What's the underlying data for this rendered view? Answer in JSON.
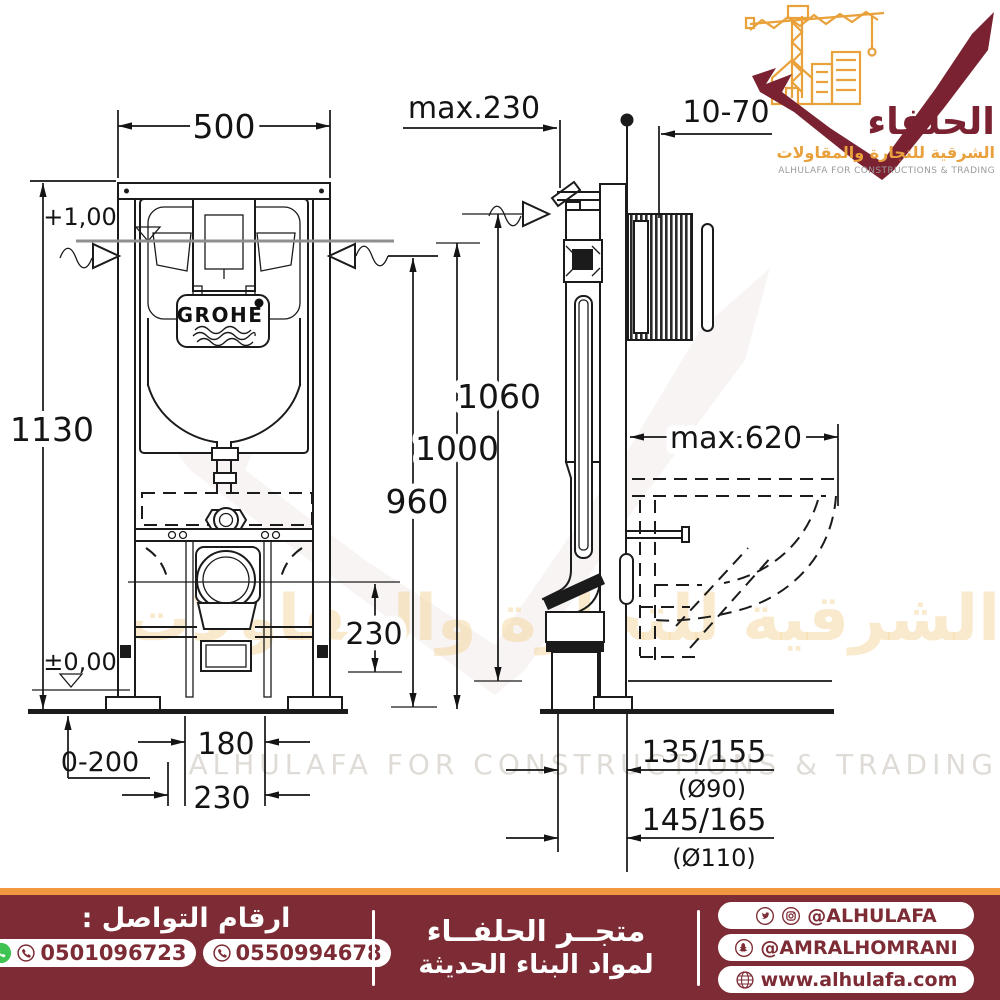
{
  "brand": {
    "name_ar": "الحلفاء",
    "tagline_ar": "الشرقية للتجارة والمقاولات",
    "tagline_en": "ALHULAFA FOR CONSTRUCTIONS & TRADING"
  },
  "drawing": {
    "grohe": "GROHE",
    "dims": {
      "width_top": "500",
      "height_left": "1130",
      "level_top": "+1,00",
      "level_floor": "±0,00",
      "depth_max": "max.230",
      "plate_range": "10-70",
      "h_1060": "1060",
      "h_1000": "1000",
      "h_960": "960",
      "outlet_height": "230",
      "bowl_depth": "max.620",
      "feet_range": "0-200",
      "w_180": "180",
      "w_230": "230",
      "drain_a": "135/155",
      "drain_a_dia": "(Ø90)",
      "drain_b": "145/165",
      "drain_b_dia": "(Ø110)"
    },
    "watermark": {
      "line_ar": "الشرقية للتجارة والمقاولات",
      "line_en": "ALHULAFA FOR CONSTRUCTIONS & TRADING"
    }
  },
  "footer": {
    "contact_title": "ارقام التواصل :",
    "phone_1": "0501096723",
    "phone_2": "0550994678",
    "store_line1": "متجــر الحلفــاء",
    "store_line2": "لمواد البناء الحديثة",
    "social_1": "@ALHULAFA",
    "social_2": "@AMRALHOMRANI",
    "social_3": "www.alhulafa.com"
  }
}
